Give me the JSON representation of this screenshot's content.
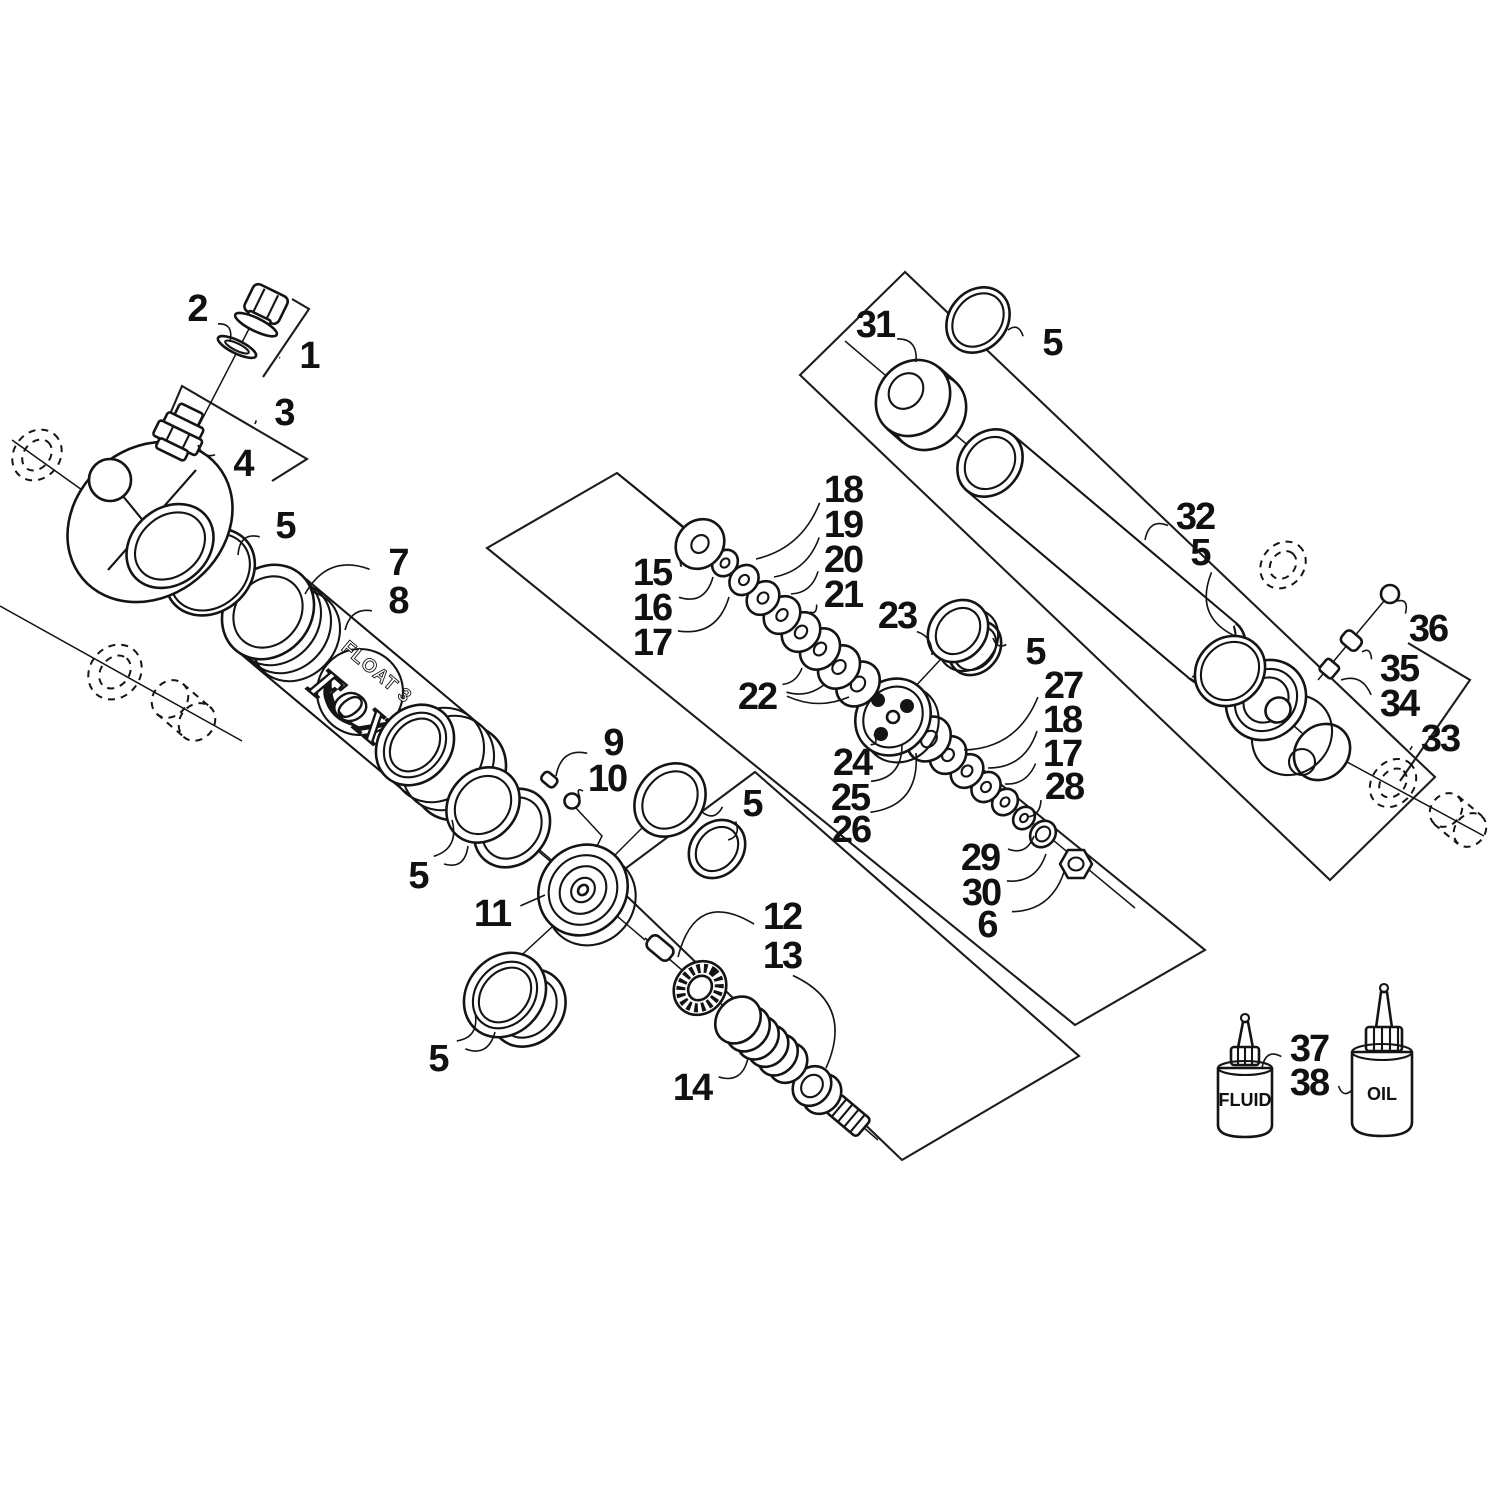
{
  "figure": {
    "type": "exploded-parts-diagram",
    "subject": "FOX FLOAT 3 front suspension shock absorber assembly",
    "background_color": "#ffffff",
    "line_color": "#141414"
  },
  "decal": {
    "brand": "FOX",
    "model": "FLOAT 3"
  },
  "bottles": {
    "fluid_label": "FLUID",
    "oil_label": "OIL"
  },
  "callouts": [
    {
      "label": "2",
      "x": 197,
      "y": 308,
      "t": [
        [
          230,
          342
        ]
      ],
      "bend": -0.3
    },
    {
      "label": "1",
      "x": 309,
      "y": 355,
      "t": [
        [
          280,
          358
        ]
      ],
      "bend": 0
    },
    {
      "label": "3",
      "x": 284,
      "y": 412,
      "t": [
        [
          255,
          424
        ]
      ],
      "bend": 0
    },
    {
      "label": "4",
      "x": 243,
      "y": 463,
      "t": [
        [
          198,
          445
        ]
      ],
      "bend": -0.2
    },
    {
      "label": "5",
      "x": 285,
      "y": 525,
      "t": [
        [
          238,
          555
        ]
      ],
      "bend": 0.3
    },
    {
      "label": "7",
      "x": 398,
      "y": 562,
      "t": [
        [
          305,
          594
        ]
      ],
      "bend": 0.3
    },
    {
      "label": "8",
      "x": 398,
      "y": 600,
      "t": [
        [
          345,
          630
        ]
      ],
      "bend": 0.25
    },
    {
      "label": "9",
      "x": 613,
      "y": 742,
      "t": [
        [
          556,
          776
        ]
      ],
      "bend": 0.3
    },
    {
      "label": "10",
      "x": 607,
      "y": 778,
      "t": [
        [
          580,
          798
        ]
      ],
      "bend": 0.3
    },
    {
      "label": "5",
      "x": 752,
      "y": 803,
      "t": [
        [
          702,
          812
        ],
        [
          728,
          840
        ]
      ],
      "bend": -0.25
    },
    {
      "label": "11",
      "x": 492,
      "y": 913,
      "t": [
        [
          545,
          895
        ]
      ],
      "bend": 0
    },
    {
      "label": "5",
      "x": 418,
      "y": 875,
      "t": [
        [
          452,
          820
        ],
        [
          468,
          846
        ]
      ],
      "bend": 0.3
    },
    {
      "label": "5",
      "x": 438,
      "y": 1058,
      "t": [
        [
          475,
          1012
        ],
        [
          495,
          1032
        ]
      ],
      "bend": 0.3
    },
    {
      "label": "12",
      "x": 782,
      "y": 916,
      "t": [
        [
          678,
          957
        ]
      ],
      "bend": 0.5
    },
    {
      "label": "13",
      "x": 782,
      "y": 955,
      "t": [
        [
          826,
          1068
        ]
      ],
      "bend": -0.4
    },
    {
      "label": "14",
      "x": 692,
      "y": 1087,
      "t": [
        [
          748,
          1058
        ]
      ],
      "bend": 0.3
    },
    {
      "label": "15",
      "x": 652,
      "y": 572,
      "t": [
        [
          680,
          562
        ]
      ],
      "bend": 0.2
    },
    {
      "label": "16",
      "x": 652,
      "y": 607,
      "t": [
        [
          713,
          577
        ]
      ],
      "bend": 0.3
    },
    {
      "label": "17",
      "x": 652,
      "y": 642,
      "t": [
        [
          729,
          597
        ]
      ],
      "bend": 0.3
    },
    {
      "label": "18",
      "x": 843,
      "y": 489,
      "t": [
        [
          756,
          559
        ]
      ],
      "bend": -0.2
    },
    {
      "label": "19",
      "x": 843,
      "y": 524,
      "t": [
        [
          774,
          577
        ]
      ],
      "bend": -0.2
    },
    {
      "label": "20",
      "x": 843,
      "y": 559,
      "t": [
        [
          791,
          594
        ]
      ],
      "bend": -0.2
    },
    {
      "label": "21",
      "x": 843,
      "y": 594,
      "t": [
        [
          810,
          612
        ]
      ],
      "bend": -0.2
    },
    {
      "label": "22",
      "x": 757,
      "y": 696,
      "t": [
        [
          802,
          668
        ],
        [
          825,
          684
        ],
        [
          849,
          697
        ]
      ],
      "bend": 0.15
    },
    {
      "label": "23",
      "x": 897,
      "y": 615,
      "t": [
        [
          932,
          655
        ]
      ],
      "bend": -0.2
    },
    {
      "label": "5",
      "x": 1035,
      "y": 651,
      "t": [
        [
          993,
          638
        ]
      ],
      "bend": -0.2
    },
    {
      "label": "24",
      "x": 852,
      "y": 762,
      "t": [
        [
          874,
          734
        ]
      ],
      "bend": 0.25
    },
    {
      "label": "25",
      "x": 850,
      "y": 797,
      "t": [
        [
          902,
          744
        ]
      ],
      "bend": 0.3
    },
    {
      "label": "26",
      "x": 851,
      "y": 829,
      "t": [
        [
          916,
          753
        ]
      ],
      "bend": 0.35
    },
    {
      "label": "27",
      "x": 1063,
      "y": 685,
      "t": [
        [
          964,
          750
        ]
      ],
      "bend": -0.25
    },
    {
      "label": "18",
      "x": 1062,
      "y": 719,
      "t": [
        [
          988,
          768
        ]
      ],
      "bend": -0.25
    },
    {
      "label": "17",
      "x": 1062,
      "y": 753,
      "t": [
        [
          1005,
          784
        ]
      ],
      "bend": -0.2
    },
    {
      "label": "28",
      "x": 1064,
      "y": 786,
      "t": [
        [
          1027,
          817
        ]
      ],
      "bend": -0.2
    },
    {
      "label": "29",
      "x": 980,
      "y": 857,
      "t": [
        [
          1034,
          836
        ]
      ],
      "bend": 0.25
    },
    {
      "label": "30",
      "x": 981,
      "y": 892,
      "t": [
        [
          1046,
          854
        ]
      ],
      "bend": 0.25
    },
    {
      "label": "6",
      "x": 987,
      "y": 924,
      "t": [
        [
          1064,
          872
        ]
      ],
      "bend": 0.25
    },
    {
      "label": "31",
      "x": 875,
      "y": 324,
      "t": [
        [
          916,
          362
        ]
      ],
      "bend": -0.3
    },
    {
      "label": "5",
      "x": 1052,
      "y": 342,
      "t": [
        [
          1008,
          330
        ]
      ],
      "bend": 0.25
    },
    {
      "label": "32",
      "x": 1195,
      "y": 516,
      "t": [
        [
          1145,
          540
        ]
      ],
      "bend": 0.3
    },
    {
      "label": "5",
      "x": 1200,
      "y": 552,
      "t": [
        [
          1235,
          636
        ]
      ],
      "bend": 0.35
    },
    {
      "label": "36",
      "x": 1428,
      "y": 628,
      "t": [
        [
          1397,
          601
        ]
      ],
      "bend": 0.3
    },
    {
      "label": "35",
      "x": 1399,
      "y": 668,
      "t": [
        [
          1362,
          652
        ]
      ],
      "bend": 0.25
    },
    {
      "label": "34",
      "x": 1399,
      "y": 703,
      "t": [
        [
          1341,
          680
        ]
      ],
      "bend": 0.25
    },
    {
      "label": "33",
      "x": 1440,
      "y": 738,
      "t": [
        [
          1410,
          750
        ]
      ],
      "bend": 0
    },
    {
      "label": "37",
      "x": 1309,
      "y": 1048,
      "t": [
        [
          1262,
          1068
        ]
      ],
      "bend": 0.3
    },
    {
      "label": "38",
      "x": 1309,
      "y": 1082,
      "t": [
        [
          1352,
          1090
        ]
      ],
      "bend": 0.25
    }
  ]
}
